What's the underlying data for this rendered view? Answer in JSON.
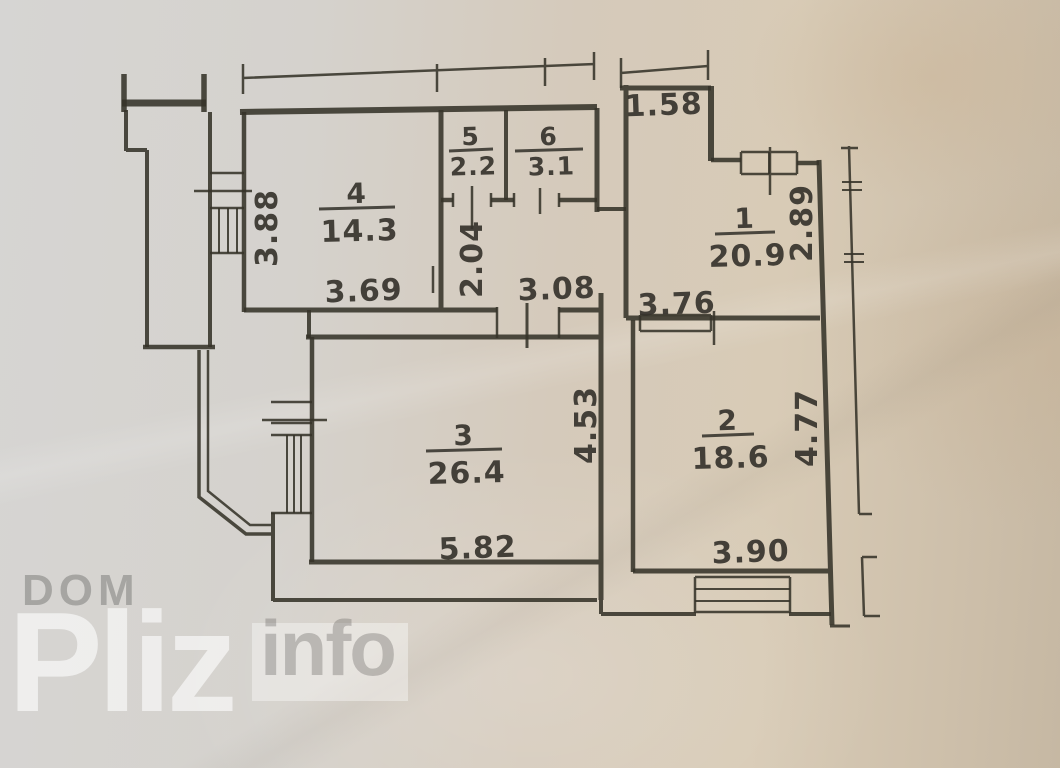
{
  "watermark": {
    "dom": "DOM",
    "pliz": "Pliz",
    "info": "info"
  },
  "colors": {
    "ink": "#363329",
    "paper_left": "#d6d5d3",
    "paper_right": "#c6b8a3",
    "watermark_light": "rgba(255,255,255,0.6)",
    "watermark_gray": "rgba(90,90,86,0.38)"
  },
  "plan": {
    "rooms": [
      {
        "id": "1",
        "number": "1",
        "area": "20.9",
        "x": 745,
        "y": 234,
        "lw": 30
      },
      {
        "id": "2",
        "number": "2",
        "area": "18.6",
        "x": 728,
        "y": 436,
        "lw": 26
      },
      {
        "id": "3",
        "number": "3",
        "area": "26.4",
        "x": 464,
        "y": 451,
        "lw": 38
      },
      {
        "id": "4",
        "number": "4",
        "area": "14.3",
        "x": 357,
        "y": 209,
        "lw": 38
      },
      {
        "id": "5",
        "number": "5",
        "area": "2.2",
        "x": 471,
        "y": 151,
        "lw": 22
      },
      {
        "id": "6",
        "number": "6",
        "area": "3.1",
        "x": 549,
        "y": 151,
        "lw": 34
      }
    ],
    "dimensions": [
      {
        "value": "1.58",
        "x": 664,
        "y": 115,
        "rotate": 0
      },
      {
        "value": "3.88",
        "x": 277,
        "y": 228,
        "rotate": -90
      },
      {
        "value": "3.69",
        "x": 364,
        "y": 301,
        "rotate": 0
      },
      {
        "value": "2.04",
        "x": 482,
        "y": 259,
        "rotate": -90
      },
      {
        "value": "3.08",
        "x": 557,
        "y": 299,
        "rotate": 0
      },
      {
        "value": "2.89",
        "x": 812,
        "y": 223,
        "rotate": -90
      },
      {
        "value": "3.76",
        "x": 677,
        "y": 314,
        "rotate": 0
      },
      {
        "value": "4.53",
        "x": 596,
        "y": 425,
        "rotate": -90
      },
      {
        "value": "4.77",
        "x": 817,
        "y": 428,
        "rotate": -90
      },
      {
        "value": "5.82",
        "x": 478,
        "y": 558,
        "rotate": 0
      },
      {
        "value": "3.90",
        "x": 751,
        "y": 562,
        "rotate": 0
      }
    ]
  }
}
